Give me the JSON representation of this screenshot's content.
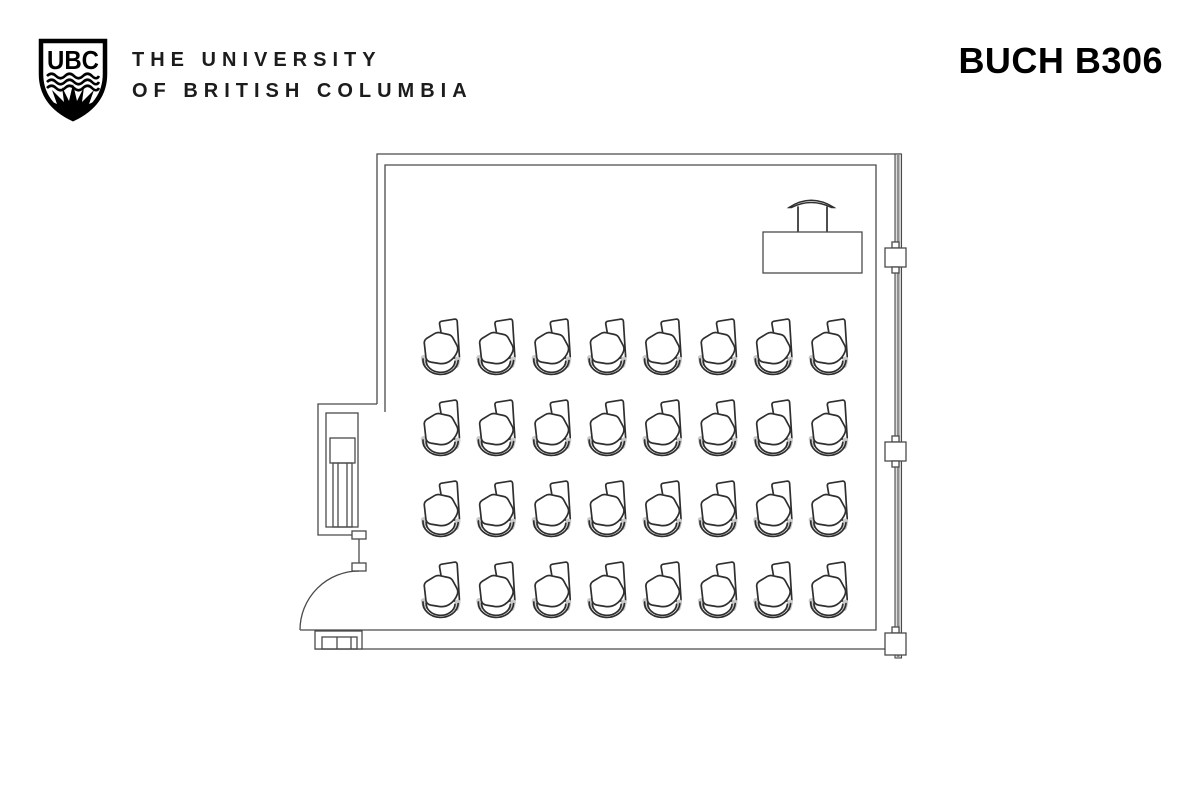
{
  "header": {
    "logo": {
      "monogram": "UBC",
      "name_line1": "THE UNIVERSITY",
      "name_line2": "OF BRITISH COLUMBIA"
    },
    "room_title": "BUCH B306"
  },
  "floor_plan": {
    "room_name": "BUCH B306",
    "type": "classroom-floor-plan",
    "seating": {
      "rows": 4,
      "columns": 8,
      "total_seats": 32,
      "seat_type": "tablet-arm chair"
    },
    "instructor_area": {
      "items": [
        "instructor-desk",
        "instructor-chair"
      ]
    },
    "architecture": [
      "entry-door-with-swing-arc",
      "entry-alcove-with-casework",
      "window-wall-with-mullions",
      "base-cabinet"
    ],
    "grid": {
      "origin_x": 421,
      "origin_y": 317,
      "dx": 55.4,
      "dy": 81
    },
    "colors": {
      "wall_line": "#4a4a4a",
      "chair_line": "#2f2f2f",
      "pad_gray": "#c9c9c9",
      "window_fill": "#dedede",
      "window_core": "#8f8f8f",
      "background": "#ffffff"
    }
  }
}
